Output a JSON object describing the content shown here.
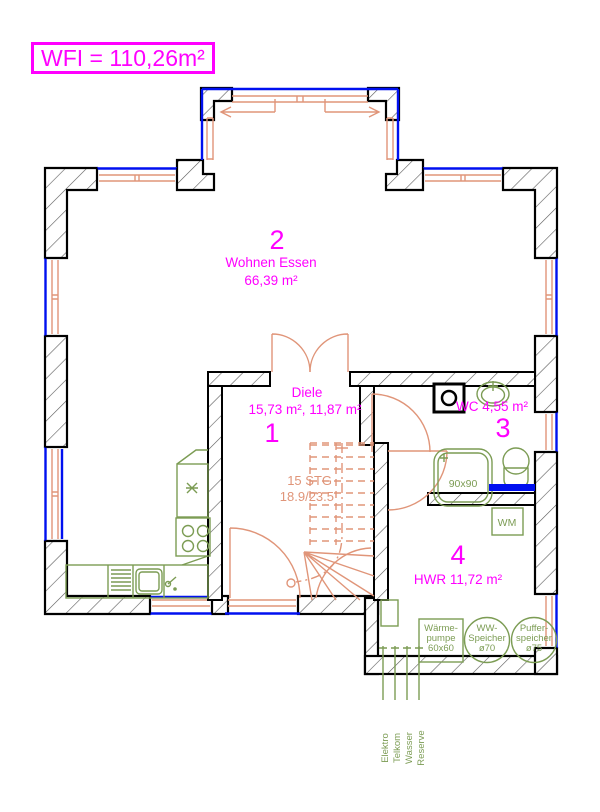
{
  "title": {
    "label": "WFI = 110,26m²"
  },
  "colors": {
    "accent_magenta": "#ff00ff",
    "window_blue": "#0010f0",
    "fixture_green": "#7c9c54",
    "door_salmon": "#e09579",
    "wall_black": "#000000"
  },
  "rooms": {
    "wohnen": {
      "number": "2",
      "name": "Wohnen Essen",
      "area": "66,39 m²"
    },
    "diele": {
      "number": "1",
      "name": "Diele",
      "area": "15,73 m², 11,87 m²"
    },
    "wc": {
      "number": "3",
      "label": "WC 4,55 m²"
    },
    "hwr": {
      "number": "4",
      "label": "HWR 11,72 m²"
    }
  },
  "stairs": {
    "count": "15 STG",
    "dimensions": "18.9/23.5"
  },
  "fixtures": {
    "shower_label": "90x90",
    "washing_machine_label": "WM"
  },
  "equipment": {
    "heat_pump": {
      "line1": "Wärme-",
      "line2": "pumpe",
      "line3": "60x60"
    },
    "ww_storage": {
      "line1": "WW-",
      "line2": "Speicher",
      "line3": "ø70"
    },
    "buffer_storage": {
      "line1": "Puffer-",
      "line2": "speicher",
      "line3": "ø75"
    }
  },
  "utilities": {
    "items": [
      {
        "label": "Elektro"
      },
      {
        "label": "Telkom"
      },
      {
        "label": "Wasser"
      },
      {
        "label": "Reserve"
      }
    ]
  }
}
